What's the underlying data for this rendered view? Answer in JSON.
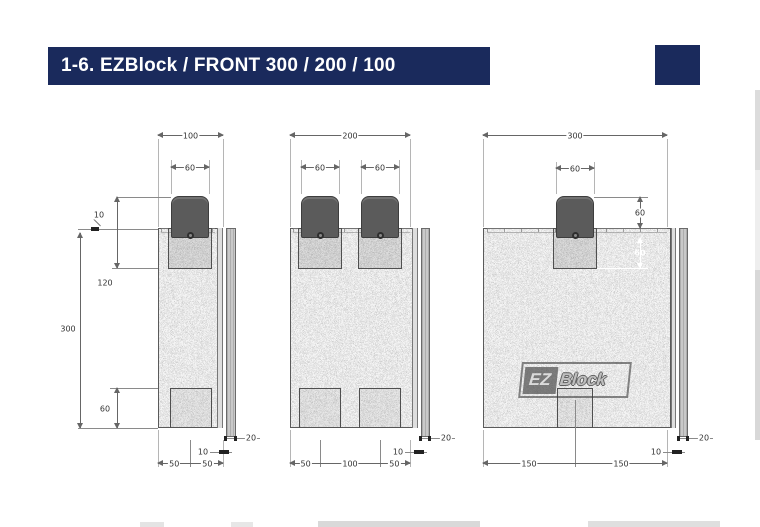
{
  "title_bar": {
    "text": "1-6. EZBlock / FRONT 300 / 200 / 100",
    "bg": "#1a2a5c",
    "fg": "#ffffff"
  },
  "decor": {
    "corner_square_color": "#1a2a5c"
  },
  "colors": {
    "foam_gray": "#c6c6c6",
    "knob_gray": "#5b5b5b",
    "dim_line_gray": "#666666"
  },
  "logo": {
    "ez": "EZ",
    "block": "Block"
  },
  "drawings": {
    "front100": {
      "overall_width": "100",
      "knob_width": "60",
      "top_lip": "10",
      "knob_to_socket_depth": "120",
      "overall_height": "300",
      "bottom_recess": "60",
      "bottom_left": "50",
      "bottom_right": "50",
      "side_gap": "10",
      "side_panel": "20"
    },
    "front200": {
      "overall_width": "200",
      "knob1_width": "60",
      "knob2_width": "60",
      "bottom_left": "50",
      "bottom_mid": "100",
      "bottom_right": "50",
      "side_gap": "10",
      "side_panel": "20"
    },
    "front300": {
      "overall_width": "300",
      "knob_width": "60",
      "knob_height": "60",
      "socket_depth": "60",
      "bottom_left": "150",
      "bottom_right": "150",
      "side_gap": "10",
      "side_panel": "20"
    }
  }
}
